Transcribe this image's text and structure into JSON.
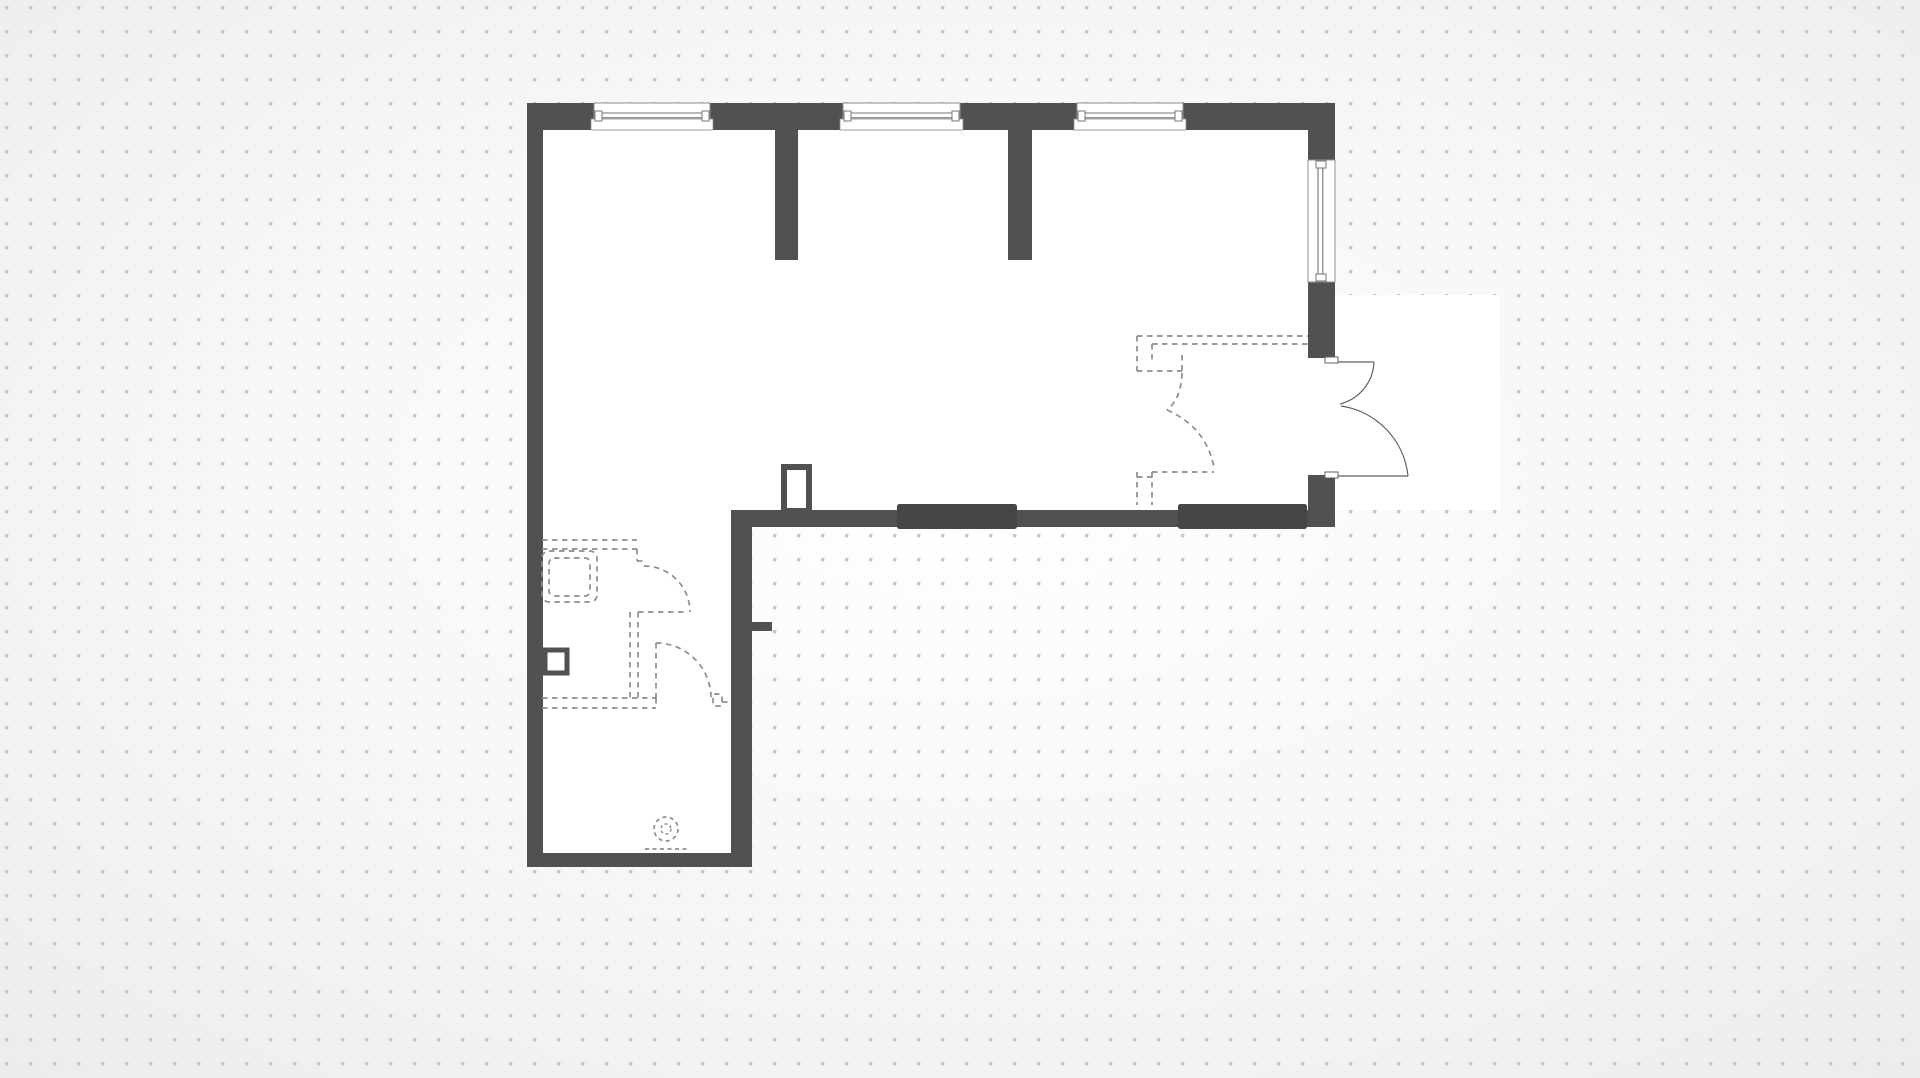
{
  "canvas": {
    "width": 1920,
    "height": 1078,
    "edge_color": "#ececec",
    "center_color": "#ffffff",
    "dot_color": "#c6c6c6",
    "dot_size": 3.4,
    "dot_spacing": 24,
    "dot_offset_x": 5,
    "dot_offset_y": 6
  },
  "palette": {
    "wall": "#515151",
    "wall_dark": "#464646",
    "floor": "#ffffff",
    "window_outline": "#8f8f8f",
    "window_line": "#757575",
    "door_line": "#5f5f5f",
    "dashed_line": "#8d8d8d"
  },
  "floor_plan": {
    "footprint_points": "527,103 1335,103 1335,527 752,527 752,867 527,867",
    "exterior_halo": {
      "x": 1330,
      "y": 295,
      "w": 170,
      "h": 215
    },
    "walls": [
      {
        "name": "wall-top",
        "x": 527,
        "y": 103,
        "w": 808,
        "h": 27
      },
      {
        "name": "wall-left",
        "x": 527,
        "y": 103,
        "w": 16,
        "h": 764
      },
      {
        "name": "wall-bottom-lower",
        "x": 527,
        "y": 853,
        "w": 225,
        "h": 14
      },
      {
        "name": "wall-interior-vertical",
        "x": 731,
        "y": 510,
        "w": 21,
        "h": 357
      },
      {
        "name": "wall-interior-stub",
        "x": 752,
        "y": 622,
        "w": 20,
        "h": 9
      },
      {
        "name": "wall-bottom-upper",
        "x": 731,
        "y": 510,
        "w": 604,
        "h": 17
      },
      {
        "name": "wall-right-upper",
        "x": 1308,
        "y": 130,
        "w": 27,
        "h": 228
      },
      {
        "name": "wall-right-lower",
        "x": 1308,
        "y": 475,
        "w": 27,
        "h": 52
      },
      {
        "name": "partition-stub-1",
        "x": 775,
        "y": 130,
        "w": 23,
        "h": 130
      },
      {
        "name": "partition-stub-2",
        "x": 1008,
        "y": 130,
        "w": 24,
        "h": 130
      }
    ],
    "wall_accents": [
      {
        "name": "wall-segment-dark-1",
        "x": 897,
        "y": 504,
        "w": 120,
        "h": 25
      },
      {
        "name": "wall-segment-dark-2",
        "x": 1178,
        "y": 504,
        "w": 129,
        "h": 25
      }
    ],
    "windows": [
      {
        "name": "window-top-1",
        "orientation": "h",
        "x": 594,
        "y": 103,
        "w": 116,
        "h": 27
      },
      {
        "name": "window-top-2",
        "orientation": "h",
        "x": 843,
        "y": 103,
        "w": 117,
        "h": 27
      },
      {
        "name": "window-top-3",
        "orientation": "h",
        "x": 1077,
        "y": 103,
        "w": 106,
        "h": 27
      },
      {
        "name": "window-right",
        "orientation": "v",
        "x": 1308,
        "y": 160,
        "w": 27,
        "h": 122
      }
    ],
    "entry_door": {
      "caps": [
        {
          "x": 1325,
          "y": 357,
          "w": 13,
          "h": 6
        },
        {
          "x": 1325,
          "y": 472,
          "w": 13,
          "h": 6
        }
      ],
      "leaves": [
        "M 1330 362 H 1374",
        "M 1330 476 H 1408"
      ],
      "swings": [
        "M 1374 362 A 45 45 0 0 1 1340 404",
        "M 1408 476 A 79 79 0 0 0 1341 406"
      ]
    },
    "dashed_annotations": {
      "entry_previous_layout": [
        "M 1137 336 H 1308",
        "M 1152 344 H 1308",
        "M 1137 336 V 371",
        "M 1152 344 V 364",
        "M 1137 371 H 1182",
        "M 1182 355 V 373",
        "M 1182 373 Q 1181 399 1167 410",
        "M 1167 410 Q 1206 427 1214 467",
        "M 1152 472 H 1214",
        "M 1137 472 V 505",
        "M 1152 472 V 505",
        "M 1137 477 H 1152"
      ],
      "bath_previous_layout": [
        "M 542 540 H 637",
        "M 542 549 H 637",
        "M 637 549 V 561",
        "M 637 561 H 643",
        "M 644 566 A 46 46 0 0 1 690 612",
        "M 630 612 V 698",
        "M 638 612 V 698",
        "M 638 612 H 688",
        "M 656 643 V 698",
        "M 656 643 A 55 55 0 0 1 711 698",
        "M 542 698 H 656",
        "M 542 708 H 656",
        "M 656 698 V 708",
        "M 722 702 H 731"
      ],
      "bath_fixture_outer": {
        "x": 542,
        "y": 551,
        "w": 55,
        "h": 51,
        "rx": 7
      },
      "bath_fixture_inner": {
        "x": 549,
        "y": 558,
        "w": 41,
        "h": 38,
        "rx": 5
      },
      "bath_small_rect": {
        "x": 713,
        "y": 694,
        "w": 9,
        "h": 12,
        "rx": 1
      },
      "toilet": {
        "cx": 666,
        "cy": 829,
        "r_outer": 12,
        "r_inner": 5,
        "base_line": "M 645 849 H 688"
      }
    },
    "solid_fixtures": [
      {
        "name": "door-frame-column",
        "x": 784,
        "y": 467,
        "w": 25,
        "h": 44,
        "stroke_w": 6
      },
      {
        "name": "wall-niche",
        "x": 545,
        "y": 650,
        "w": 22,
        "h": 23,
        "stroke_w": 5
      }
    ]
  }
}
